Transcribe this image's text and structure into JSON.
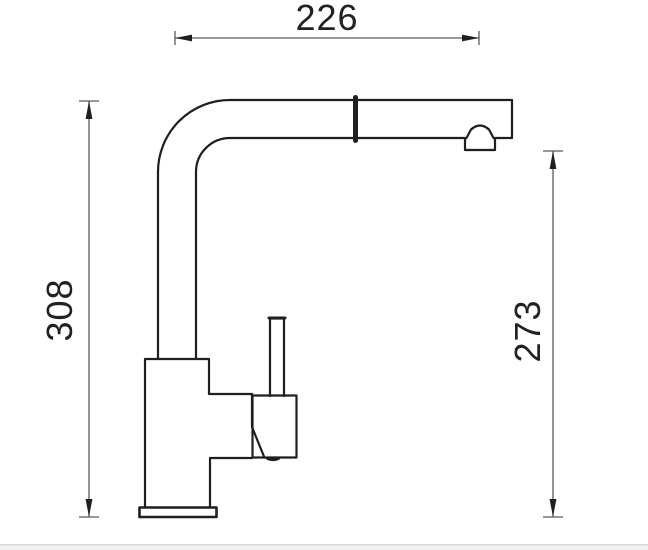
{
  "drawing": {
    "type": "technical-dimension-drawing",
    "subject": "kitchen-faucet-side-view",
    "dimensions": {
      "top_width": {
        "value": "226",
        "orientation": "horizontal"
      },
      "left_height": {
        "value": "308",
        "orientation": "vertical"
      },
      "right_height": {
        "value": "273",
        "orientation": "vertical"
      }
    },
    "colors": {
      "outline": "#1f1f1f",
      "dimension_line": "#5a5a5a",
      "dimension_marks": "#1f1f1f",
      "divider": "#d7d7d7",
      "footer_band": "#f1f1f1",
      "background": "#ffffff"
    }
  }
}
